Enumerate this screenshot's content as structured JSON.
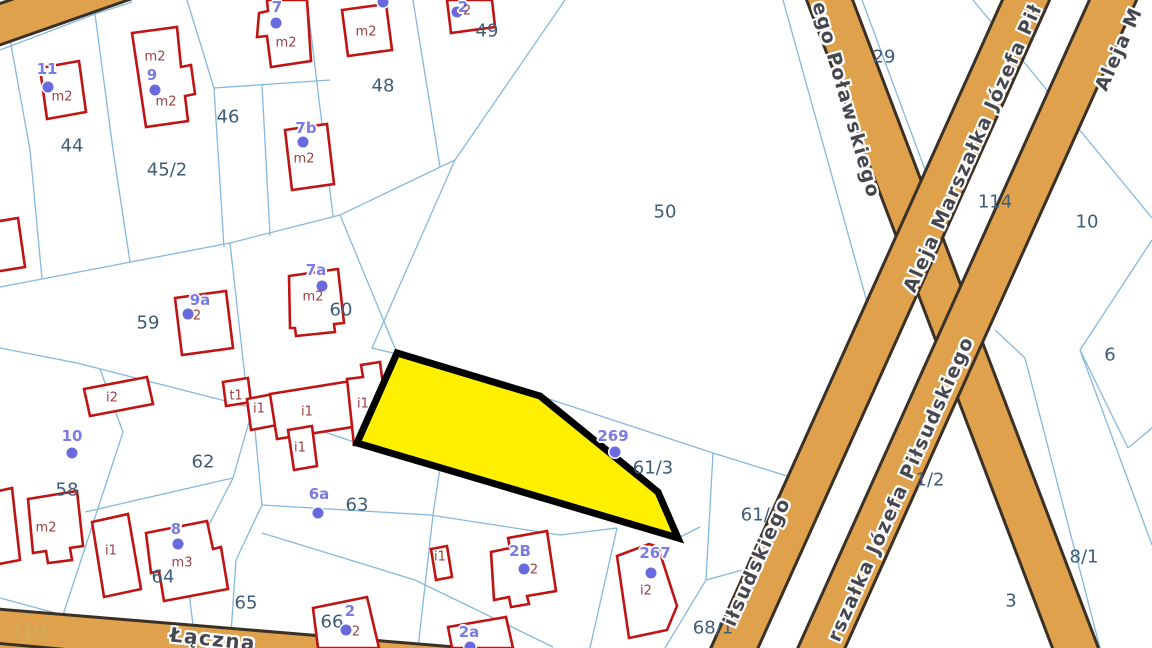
{
  "map": {
    "colors": {
      "selected_parcel_fill": "#fff000",
      "selected_parcel_border": "#000000",
      "road_fill": "#e0a14d",
      "road_casing": "#3a3126",
      "parcel_line": "#86b8dd",
      "building_outline": "#c01414",
      "parcel_label": "#3d5c78",
      "address_label": "#7b7be4",
      "building_label": "#9a4040",
      "road_label": "#46464f",
      "road_parcel_label": "#c9b267"
    },
    "parcel_labels": [
      {
        "t": "44",
        "x": 72,
        "y": 146
      },
      {
        "t": "45/2",
        "x": 167,
        "y": 170
      },
      {
        "t": "46",
        "x": 228,
        "y": 117
      },
      {
        "t": "48",
        "x": 383,
        "y": 86
      },
      {
        "t": "49",
        "x": 487,
        "y": 31
      },
      {
        "t": "50",
        "x": 665,
        "y": 212
      },
      {
        "t": "29",
        "x": 884,
        "y": 57
      },
      {
        "t": "114",
        "x": 995,
        "y": 202
      },
      {
        "t": "10",
        "x": 1087,
        "y": 222
      },
      {
        "t": "6",
        "x": 1110,
        "y": 355
      },
      {
        "t": "1/2",
        "x": 930,
        "y": 480
      },
      {
        "t": "8/1",
        "x": 1084,
        "y": 557
      },
      {
        "t": "3",
        "x": 1011,
        "y": 601
      },
      {
        "t": "59",
        "x": 148,
        "y": 323
      },
      {
        "t": "60",
        "x": 341,
        "y": 310
      },
      {
        "t": "62",
        "x": 203,
        "y": 462
      },
      {
        "t": "58",
        "x": 67,
        "y": 490
      },
      {
        "t": "63",
        "x": 357,
        "y": 505
      },
      {
        "t": "61/3",
        "x": 653,
        "y": 468
      },
      {
        "t": "61/1",
        "x": 761,
        "y": 515
      },
      {
        "t": "64",
        "x": 163,
        "y": 577
      },
      {
        "t": "65",
        "x": 246,
        "y": 603
      },
      {
        "t": "66",
        "x": 332,
        "y": 622
      },
      {
        "t": "68/1",
        "x": 713,
        "y": 628
      },
      {
        "t": "71/2",
        "x": 30,
        "y": 631,
        "c": "#c9b267",
        "s": 16
      }
    ],
    "address_points": [
      {
        "t": "11",
        "x": 47,
        "y": 69,
        "dx": 48,
        "dy": 87
      },
      {
        "t": "9",
        "x": 152,
        "y": 75,
        "dx": 155,
        "dy": 90
      },
      {
        "t": "7",
        "x": 277,
        "y": 7,
        "dx": 276,
        "dy": 23
      },
      {
        "t": "7b",
        "x": 306,
        "y": 128,
        "dx": 303,
        "dy": 142
      },
      {
        "t": "2",
        "x": 463,
        "y": 7,
        "dx": 457,
        "dy": 12
      },
      {
        "t": "7a",
        "x": 316,
        "y": 270,
        "dx": 322,
        "dy": 286
      },
      {
        "t": "9a",
        "x": 200,
        "y": 300,
        "dx": 188,
        "dy": 314
      },
      {
        "t": "10",
        "x": 72,
        "y": 436,
        "dx": 72,
        "dy": 453
      },
      {
        "t": "8",
        "x": 176,
        "y": 529,
        "dx": 178,
        "dy": 544
      },
      {
        "t": "6a",
        "x": 319,
        "y": 494,
        "dx": 318,
        "dy": 513
      },
      {
        "t": "269",
        "x": 613,
        "y": 436,
        "dx": 615,
        "dy": 452
      },
      {
        "t": "267",
        "x": 655,
        "y": 553,
        "dx": 651,
        "dy": 573
      },
      {
        "t": "2",
        "x": 350,
        "y": 611,
        "dx": 346,
        "dy": 630
      },
      {
        "t": "2B",
        "x": 520,
        "y": 551,
        "dx": 524,
        "dy": 569
      },
      {
        "t": "2a",
        "x": 469,
        "y": 632,
        "dx": 470,
        "dy": 647
      },
      {
        "t": "",
        "x": 383,
        "y": -20,
        "dx": 383,
        "dy": 2
      }
    ],
    "building_labels": [
      {
        "t": "m2",
        "x": 62,
        "y": 97
      },
      {
        "t": "m2",
        "x": 155,
        "y": 57
      },
      {
        "t": "m2",
        "x": 166,
        "y": 102
      },
      {
        "t": "m2",
        "x": 286,
        "y": 43
      },
      {
        "t": "m2",
        "x": 366,
        "y": 32
      },
      {
        "t": "m2",
        "x": 304,
        "y": 159
      },
      {
        "t": "m2",
        "x": 313,
        "y": 297
      },
      {
        "t": "m2",
        "x": 46,
        "y": 528
      },
      {
        "t": "2",
        "x": 197,
        "y": 316
      },
      {
        "t": "2",
        "x": 467,
        "y": 11
      },
      {
        "t": "2",
        "x": 356,
        "y": 632
      },
      {
        "t": "2",
        "x": 534,
        "y": 570
      },
      {
        "t": "m3",
        "x": 182,
        "y": 563
      },
      {
        "t": "i2",
        "x": 112,
        "y": 398
      },
      {
        "t": "i2",
        "x": 646,
        "y": 591
      },
      {
        "t": "t1",
        "x": 236,
        "y": 396
      },
      {
        "t": "i1",
        "x": 259,
        "y": 409
      },
      {
        "t": "i1",
        "x": 307,
        "y": 412
      },
      {
        "t": "i1",
        "x": 363,
        "y": 404
      },
      {
        "t": "i1",
        "x": 300,
        "y": 448
      },
      {
        "t": "i1",
        "x": 111,
        "y": 551
      },
      {
        "t": "i1",
        "x": 440,
        "y": 557
      }
    ],
    "road_labels": [
      {
        "t": "ego Poławskiego",
        "x": 846,
        "y": 100,
        "a": 74,
        "s": 19
      },
      {
        "t": "Aleja Marszałka Józefa Pił",
        "x": 973,
        "y": 148,
        "a": -66,
        "s": 19
      },
      {
        "t": "Aleja M",
        "x": 1119,
        "y": 49,
        "a": -66,
        "s": 19
      },
      {
        "t": "rszałka Józefa Piłsudskiego",
        "x": 901,
        "y": 489,
        "a": -66,
        "s": 19
      },
      {
        "t": "iłsudskiego",
        "x": 757,
        "y": 562,
        "a": -66,
        "s": 19
      },
      {
        "t": "Łączna",
        "x": 213,
        "y": 639,
        "a": 6,
        "s": 20
      }
    ]
  }
}
